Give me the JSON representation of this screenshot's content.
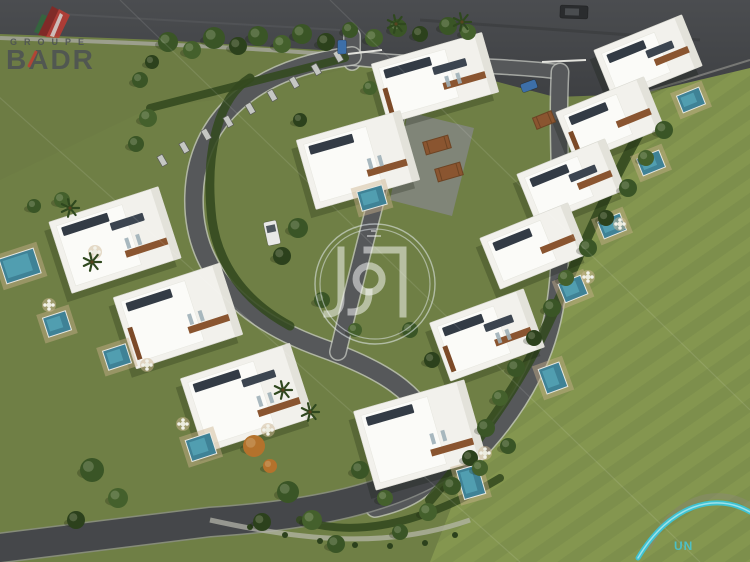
{
  "branding": {
    "groupe_label": "GROUPE",
    "badr_label": "BADR",
    "badr_icon": "building-logo-icon",
    "center_watermark_icon": "arabic-kufic-monogram-icon",
    "corner_logo_text": "UN",
    "corner_logo_icon": "swoosh-arc-icon"
  },
  "palette": {
    "grass_base": "#6f7f45",
    "grass_light": "#7d8f4c",
    "grass_stripe": "#84964f",
    "grass_top": "#6d7c44",
    "asphalt_dark": "#3e4043",
    "asphalt_mid": "#56585a",
    "asphalt_deep": "#45474a",
    "road_edge": "#c6c8c2",
    "villa_white": "#f2f1ec",
    "villa_bright": "#fbfbf8",
    "panel_dark": "#333b45",
    "wood_brown": "#8a5530",
    "pool_teal": "#3f8296",
    "pool_light": "#5aa9bb",
    "tree_green": "#3a5526",
    "tree_dark": "#2c411c",
    "tree_mid": "#44602c",
    "tree_orange": "#b4722c",
    "hedge_green": "#33491f",
    "logo_red": "#c23a32",
    "logo_dark_red": "#8d2420",
    "logo_green": "#2f6e3a",
    "logo_gray": "#4b5054",
    "swoosh_cyan": "#3cc5d8",
    "swoosh_ghost": "#8d867b",
    "watermark_white": "rgba(255,255,255,0.5)"
  },
  "scene": {
    "parking": "0,0 750,0 750,68 640,94 555,97 430,64 352,52 160,40 0,34",
    "lawns": {
      "right": "640,94 750,62 750,562 430,562 470,460 540,340 600,220 648,118",
      "top_left": "0,36 160,42 352,54 340,70 230,98 150,108 0,180"
    },
    "curb": "M640,94 L750,60",
    "sidewalk": "M0,38 C120,42 260,48 350,56",
    "walkway": "M210,520 C300,540 385,550 470,520",
    "roads": [
      {
        "d": "M352,36 L352,62",
        "w": 15,
        "k": "main"
      },
      {
        "d": "M352,58 C420,66 500,64 560,72",
        "w": 13,
        "k": "main"
      },
      {
        "d": "M352,56 C255,68 196,118 194,196 C192,268 238,318 322,348 C378,368 424,392 438,442 C446,476 420,498 375,508",
        "w": 17,
        "k": "main"
      },
      {
        "d": "M408,68 C390,150 360,260 338,352",
        "w": 15,
        "k": "main"
      },
      {
        "d": "M560,72 C556,150 566,230 556,300 C548,356 520,410 470,460 L443,470",
        "w": 16,
        "k": "main"
      },
      {
        "d": "M438,468 C380,502 300,516 210,522 L0,548",
        "w": 28,
        "k": "dark"
      }
    ],
    "driveway": "408,112 474,128 452,216 390,200",
    "hedges": [
      {
        "d": "M250,78 C215,100 205,160 212,220 C218,262 242,300 290,326",
        "w": 9
      },
      {
        "d": "M648,118 C600,200 570,280 540,340 C515,390 480,440 430,500",
        "w": 10
      },
      {
        "d": "M150,108 L345,58",
        "w": 8
      },
      {
        "d": "M300,520 C360,540 430,520 500,478",
        "w": 8
      }
    ],
    "fence_posts": [
      [
        338,
        56
      ],
      [
        316,
        69
      ],
      [
        294,
        82
      ],
      [
        272,
        95
      ],
      [
        250,
        108
      ],
      [
        228,
        121
      ],
      [
        206,
        134
      ],
      [
        184,
        147
      ],
      [
        162,
        160
      ]
    ],
    "barriers": [
      [
        348,
        54,
        382,
        50
      ],
      [
        542,
        62,
        586,
        60
      ]
    ],
    "villas": [
      {
        "x": 435,
        "y": 78,
        "w": 115,
        "h": 62,
        "r": -16
      },
      {
        "x": 358,
        "y": 160,
        "w": 108,
        "h": 72,
        "r": -16
      },
      {
        "x": 648,
        "y": 58,
        "w": 95,
        "h": 55,
        "r": -22
      },
      {
        "x": 610,
        "y": 120,
        "w": 95,
        "h": 55,
        "r": -22
      },
      {
        "x": 571,
        "y": 182,
        "w": 95,
        "h": 55,
        "r": -22
      },
      {
        "x": 534,
        "y": 246,
        "w": 95,
        "h": 55,
        "r": -22
      },
      {
        "x": 487,
        "y": 335,
        "w": 100,
        "h": 62,
        "r": -20
      },
      {
        "x": 420,
        "y": 435,
        "w": 115,
        "h": 82,
        "r": -16
      },
      {
        "x": 115,
        "y": 240,
        "w": 115,
        "h": 75,
        "r": -18
      },
      {
        "x": 178,
        "y": 316,
        "w": 112,
        "h": 75,
        "r": -18
      },
      {
        "x": 247,
        "y": 398,
        "w": 115,
        "h": 78,
        "r": -18
      }
    ],
    "pools": [
      {
        "x": 691,
        "y": 100,
        "w": 24,
        "h": 18,
        "r": -22
      },
      {
        "x": 651,
        "y": 163,
        "w": 24,
        "h": 18,
        "r": -22
      },
      {
        "x": 612,
        "y": 226,
        "w": 24,
        "h": 18,
        "r": -22
      },
      {
        "x": 573,
        "y": 289,
        "w": 24,
        "h": 20,
        "r": -22
      },
      {
        "x": 553,
        "y": 378,
        "w": 22,
        "h": 26,
        "r": -20
      },
      {
        "x": 471,
        "y": 482,
        "w": 22,
        "h": 30,
        "r": -16
      },
      {
        "x": 20,
        "y": 266,
        "w": 36,
        "h": 26,
        "r": -18
      },
      {
        "x": 57,
        "y": 324,
        "w": 24,
        "h": 20,
        "r": -18
      },
      {
        "x": 117,
        "y": 357,
        "w": 24,
        "h": 20,
        "r": -18
      },
      {
        "x": 201,
        "y": 447,
        "w": 26,
        "h": 22,
        "r": -18
      },
      {
        "x": 372,
        "y": 198,
        "w": 26,
        "h": 20,
        "r": -16
      }
    ],
    "pergolas": [
      [
        437,
        145,
        26,
        13,
        -16
      ],
      [
        449,
        172,
        26,
        13,
        -16
      ],
      [
        544,
        120,
        20,
        12,
        -22
      ]
    ],
    "patios": [
      [
        49,
        305
      ],
      [
        147,
        365
      ],
      [
        183,
        424
      ],
      [
        485,
        453
      ],
      [
        620,
        224
      ],
      [
        588,
        277
      ],
      [
        95,
        252
      ],
      [
        268,
        430
      ]
    ],
    "trees": [
      [
        168,
        42,
        10,
        0
      ],
      [
        192,
        50,
        9,
        1
      ],
      [
        214,
        38,
        11,
        0
      ],
      [
        238,
        46,
        9,
        2
      ],
      [
        258,
        36,
        10,
        0
      ],
      [
        282,
        44,
        9,
        1
      ],
      [
        302,
        34,
        10,
        0
      ],
      [
        326,
        42,
        9,
        2
      ],
      [
        350,
        30,
        8,
        0
      ],
      [
        374,
        38,
        9,
        1
      ],
      [
        398,
        28,
        9,
        0
      ],
      [
        420,
        34,
        8,
        2
      ],
      [
        448,
        26,
        9,
        0
      ],
      [
        468,
        32,
        8,
        1
      ],
      [
        152,
        62,
        7,
        2
      ],
      [
        140,
        80,
        8,
        0
      ],
      [
        148,
        118,
        9,
        1
      ],
      [
        136,
        144,
        8,
        0
      ],
      [
        62,
        200,
        8,
        1
      ],
      [
        34,
        206,
        7,
        0
      ],
      [
        282,
        256,
        9,
        2
      ],
      [
        298,
        228,
        10,
        0
      ],
      [
        664,
        130,
        9,
        0
      ],
      [
        646,
        158,
        8,
        1
      ],
      [
        628,
        188,
        9,
        0
      ],
      [
        606,
        218,
        8,
        2
      ],
      [
        588,
        248,
        9,
        0
      ],
      [
        566,
        278,
        8,
        1
      ],
      [
        552,
        308,
        9,
        0
      ],
      [
        534,
        338,
        8,
        2
      ],
      [
        516,
        368,
        9,
        0
      ],
      [
        500,
        398,
        8,
        1
      ],
      [
        486,
        428,
        9,
        0
      ],
      [
        470,
        458,
        8,
        2
      ],
      [
        452,
        486,
        9,
        0
      ],
      [
        428,
        512,
        9,
        1
      ],
      [
        400,
        532,
        8,
        0
      ],
      [
        92,
        470,
        12,
        0
      ],
      [
        118,
        498,
        10,
        1
      ],
      [
        76,
        520,
        9,
        2
      ],
      [
        288,
        492,
        11,
        0
      ],
      [
        312,
        520,
        10,
        1
      ],
      [
        336,
        544,
        9,
        0
      ],
      [
        262,
        522,
        9,
        2
      ],
      [
        480,
        468,
        8,
        1
      ],
      [
        508,
        446,
        8,
        0
      ],
      [
        254,
        446,
        11,
        3
      ],
      [
        270,
        466,
        7,
        3
      ],
      [
        370,
        88,
        7,
        1
      ],
      [
        300,
        120,
        7,
        2
      ],
      [
        322,
        300,
        8,
        0
      ],
      [
        355,
        330,
        7,
        1
      ],
      [
        410,
        330,
        8,
        0
      ],
      [
        432,
        360,
        8,
        2
      ],
      [
        360,
        470,
        9,
        0
      ],
      [
        385,
        498,
        8,
        1
      ]
    ],
    "bushes": [
      [
        250,
        527
      ],
      [
        285,
        535
      ],
      [
        320,
        541
      ],
      [
        355,
        545
      ],
      [
        390,
        546
      ],
      [
        425,
        543
      ],
      [
        455,
        535
      ]
    ],
    "palms": [
      [
        70,
        208
      ],
      [
        92,
        262
      ],
      [
        283,
        390
      ],
      [
        396,
        24
      ],
      [
        462,
        22
      ],
      [
        310,
        412
      ]
    ],
    "cars": [
      {
        "x": 272,
        "y": 233,
        "w": 13,
        "h": 24,
        "r": -12,
        "c": "white"
      },
      {
        "x": 574,
        "y": 12,
        "w": 28,
        "h": 13,
        "r": 2,
        "c": "dark"
      },
      {
        "x": 342,
        "y": 47,
        "w": 9,
        "h": 14,
        "r": 0,
        "c": "blue"
      },
      {
        "x": 529,
        "y": 86,
        "w": 16,
        "h": 9,
        "r": -20,
        "c": "blue"
      }
    ],
    "watermark_lines": [
      [
        -20,
        80,
        520,
        562
      ],
      [
        120,
        0,
        700,
        562
      ],
      [
        330,
        0,
        750,
        410
      ]
    ]
  }
}
